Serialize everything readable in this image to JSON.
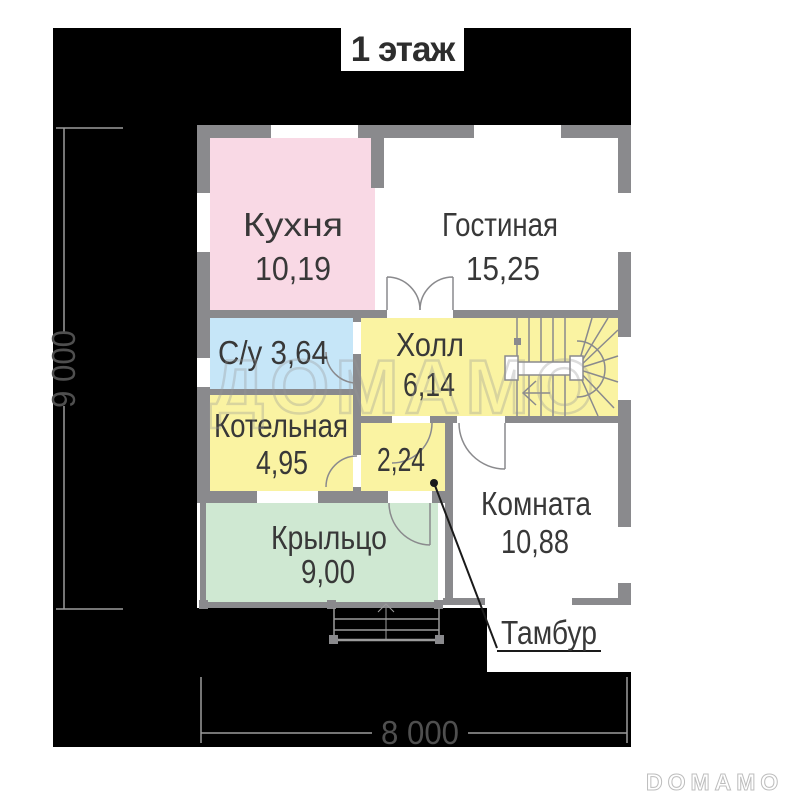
{
  "title": "1 этаж",
  "watermark": "ДОМАМО",
  "brand": "DOMAMO",
  "dimensions": {
    "height_label": "9 000",
    "width_label": "8 000"
  },
  "rooms": {
    "kitchen": {
      "name": "Кухня",
      "area": "10,19",
      "color": "#f9d9e5"
    },
    "living": {
      "name": "Гостиная",
      "area": "15,25",
      "color": "#ffffff"
    },
    "bathroom": {
      "label": "С/у 3,64",
      "color": "#c6e6f8"
    },
    "hall": {
      "name": "Холл",
      "area": "6,14",
      "color": "#faf3a2"
    },
    "boiler": {
      "name": "Котельная",
      "area": "4,95",
      "color": "#faf3a2"
    },
    "tambour": {
      "area": "2,24",
      "color": "#faf3a2"
    },
    "bedroom": {
      "name": "Комната",
      "area": "10,88",
      "color": "#ffffff"
    },
    "porch": {
      "name": "Крыльцо",
      "area": "9,00",
      "color": "#cfe8d2"
    }
  },
  "callout": {
    "label": "Тамбур"
  },
  "colors": {
    "wall": "#8a8a8d",
    "background_mask": "#000000",
    "dimension_line": "#9c9c9c",
    "label_text": "#383838"
  }
}
